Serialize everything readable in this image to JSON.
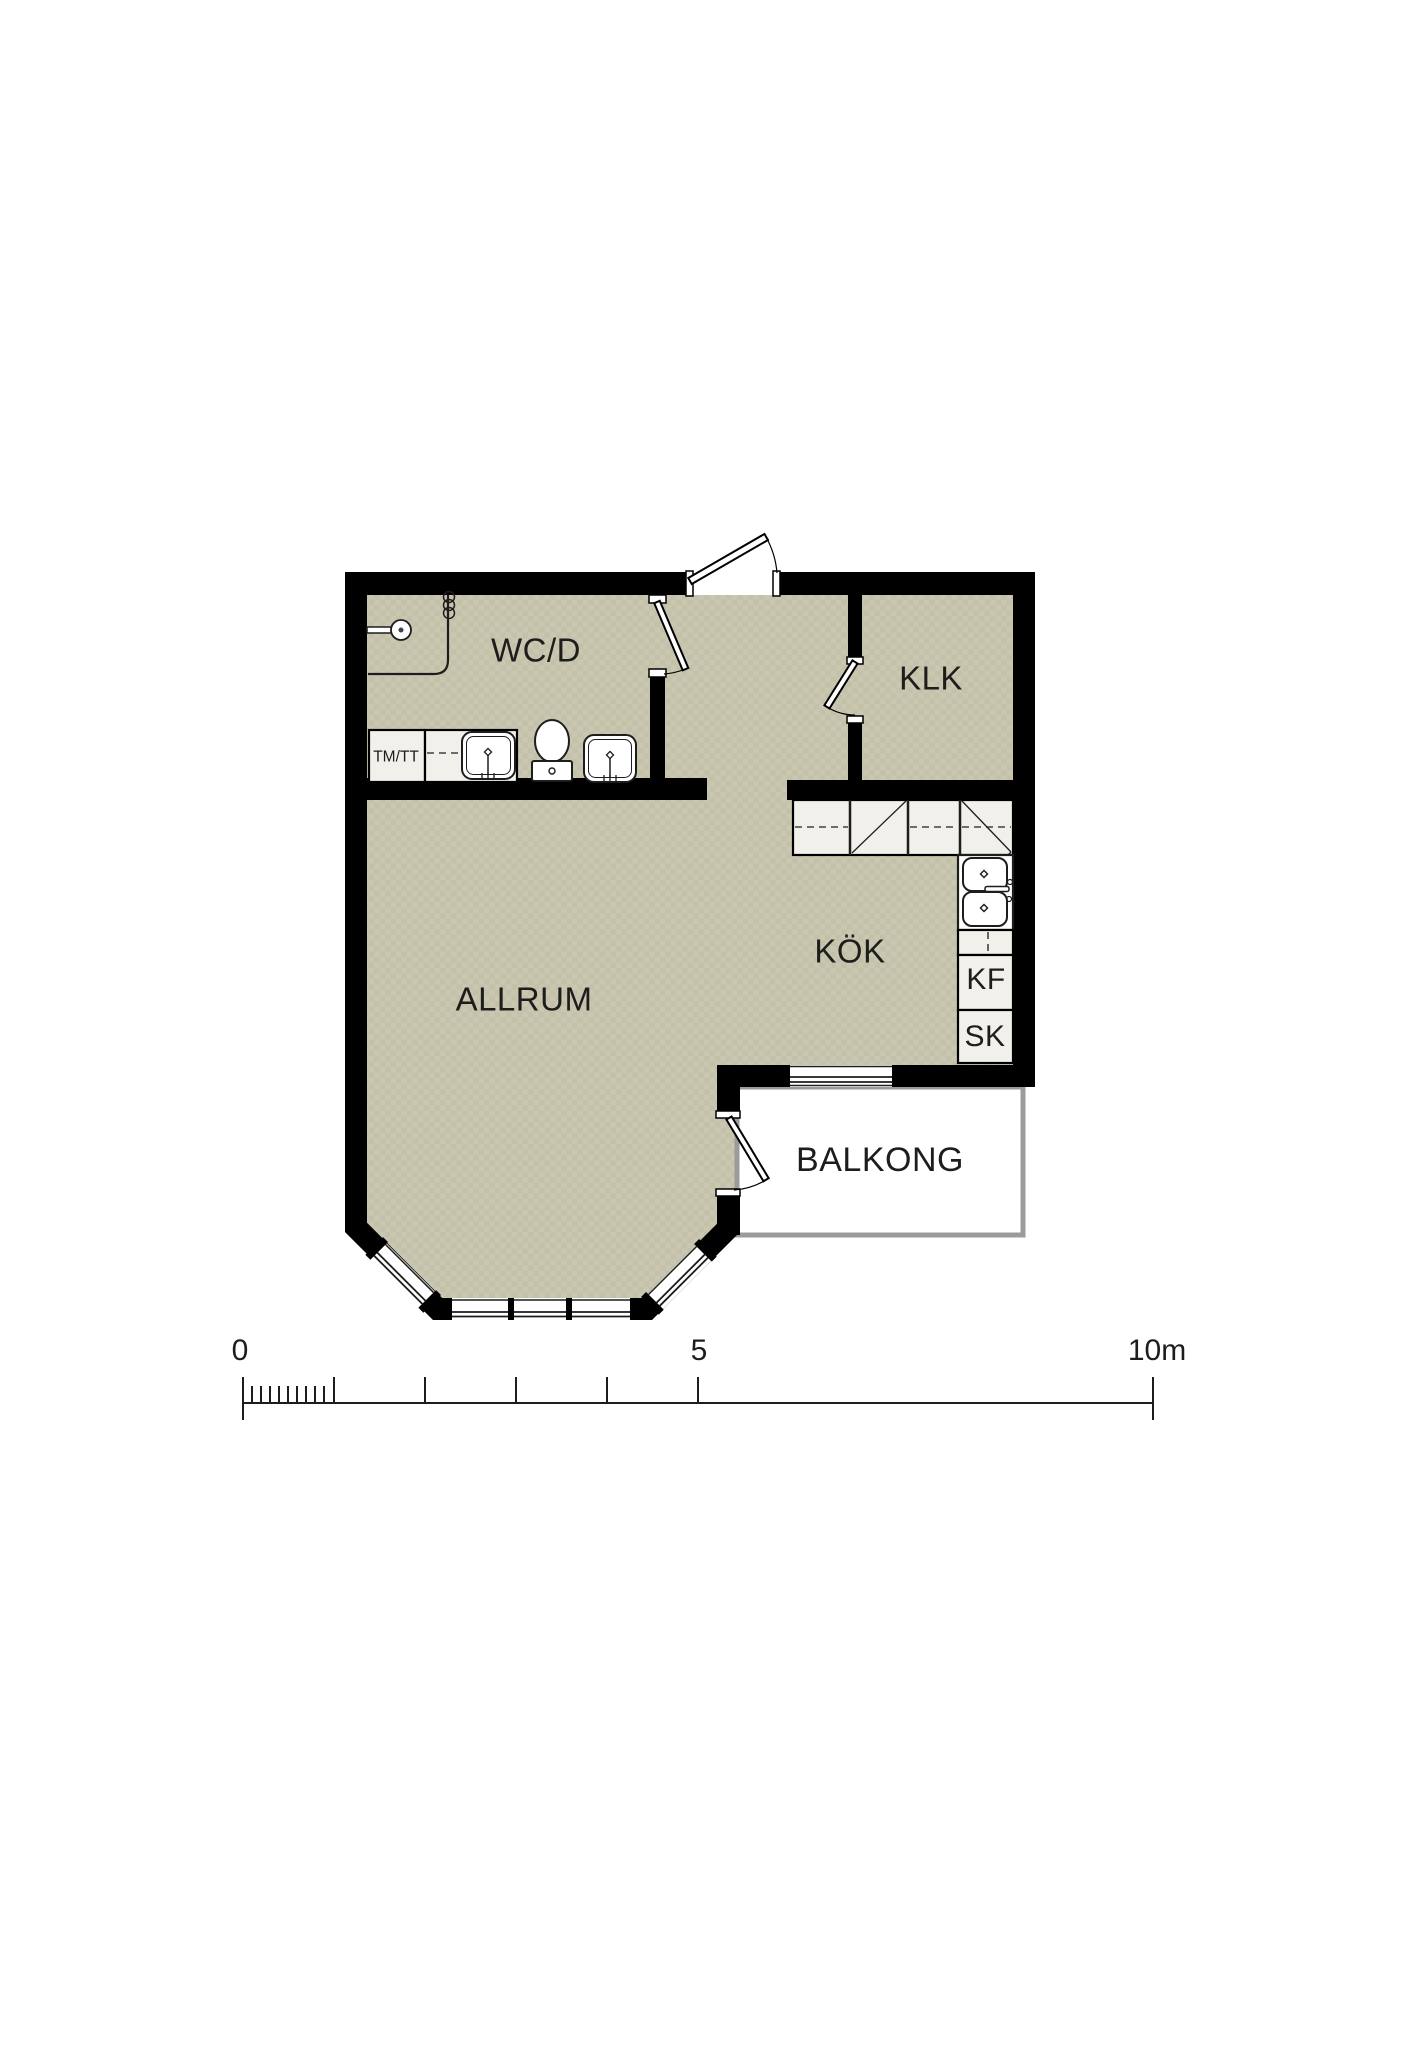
{
  "rooms": [
    {
      "id": "wcd",
      "label": "WC/D"
    },
    {
      "id": "klk",
      "label": "KLK"
    },
    {
      "id": "kok",
      "label": "KÖK"
    },
    {
      "id": "allrum",
      "label": "ALLRUM"
    },
    {
      "id": "balkong",
      "label": "BALKONG"
    }
  ],
  "fixture_labels": [
    {
      "id": "tmtt",
      "label": "TM/TT"
    },
    {
      "id": "kf",
      "label": "KF"
    },
    {
      "id": "sk",
      "label": "SK"
    }
  ],
  "scale_bar": {
    "start": "0",
    "middle": "5",
    "end": "10m"
  },
  "colors": {
    "floor": "#cac7b1",
    "floor_alt": "#c4c1ab",
    "wall": "#000000",
    "cabinet_fill": "#f1f0ea",
    "fixture_fill": "#ffffff",
    "balcony_fill": "#ffffff",
    "balcony_border": "#9b9b9b",
    "line": "#1d1d1b",
    "text": "#1d1d1b"
  }
}
